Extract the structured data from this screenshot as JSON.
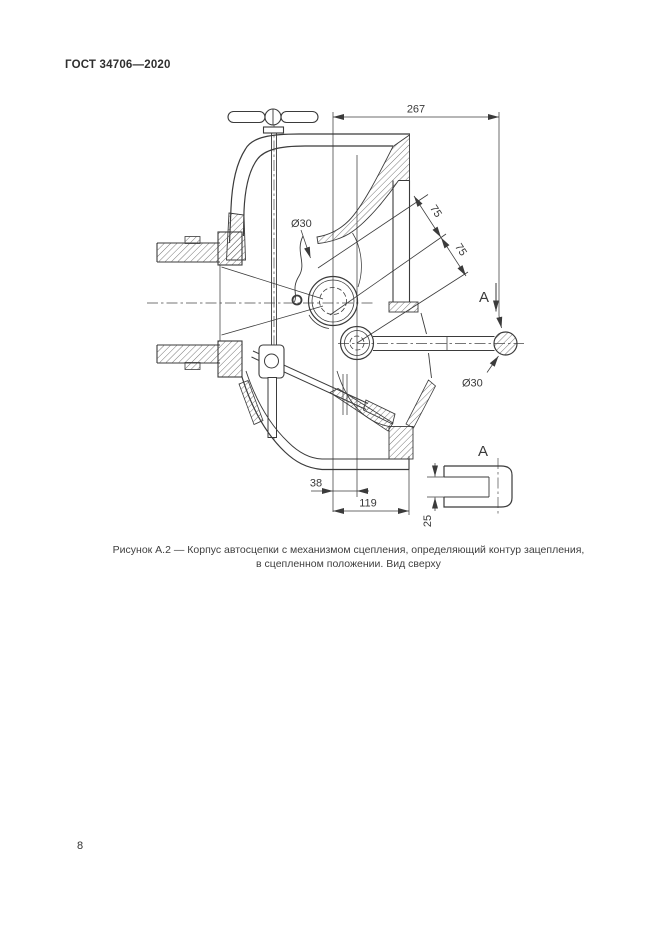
{
  "page": {
    "standard_code": "ГОСТ 34706—2020",
    "page_number": "8"
  },
  "figure": {
    "caption_line1": "Рисунок А.2 — Корпус автосцепки с механизмом сцепления, определяющий контур зацепления,",
    "caption_line2": "в сцепленном положении. Вид сверху",
    "drawing": {
      "dim_overall_width": "267",
      "dim_contour_1": "75",
      "dim_contour_2": "75",
      "dim_hole_top": "Ø30",
      "dim_shaft_end": "Ø30",
      "dim_offset": "38",
      "dim_length": "119",
      "dim_slot_height": "25",
      "view_arrow_label": "А",
      "detail_view_label": "А"
    }
  }
}
